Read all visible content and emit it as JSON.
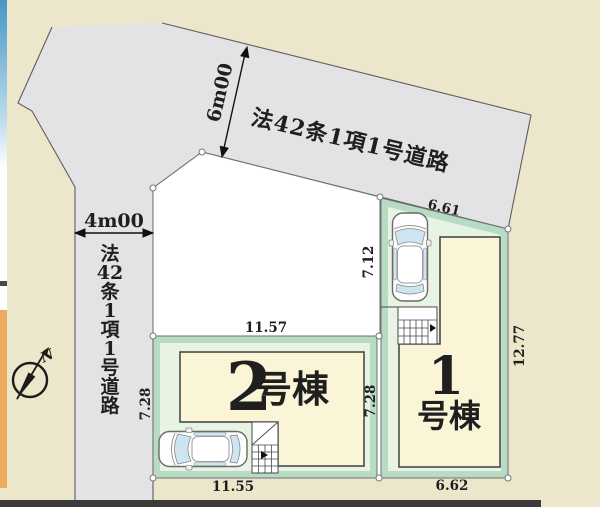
{
  "colors": {
    "background": "#ece7cb",
    "road_fill": "#e3e3e6",
    "road_stroke": "#5d5d60",
    "parcel_white": "#ffffff",
    "parcel_stroke": "#707070",
    "lot_green_outer": "#b7dcc3",
    "lot_green_inner": "#e7f3e3",
    "building_fill": "#fbf5d8",
    "building_stroke": "#3f3f3f",
    "glass_blue": "#cde4f1",
    "label_text": "#1f1f1f",
    "bottom_bar": "#3b3b3b",
    "edge_strip_blue": "#4597c7",
    "edge_strip_orange": "#ecaa5e",
    "marker_fill": "#ffffff",
    "compass_color": "#1c1c1c"
  },
  "roads": {
    "top_road_label": "法42条1項1号道路",
    "top_road_width": "6m00",
    "left_road_width": "4m00",
    "left_road_label_chars": [
      "法",
      "42",
      "条",
      "1",
      "項",
      "1",
      "号",
      "道",
      "路"
    ]
  },
  "lots": {
    "lot1": {
      "number": "1",
      "suffix": "号棟",
      "dim_top": "6.61",
      "dim_left": "7.12",
      "dim_right": "12.77",
      "dim_bottom": "6.62"
    },
    "lot2": {
      "number": "2",
      "suffix": "号棟",
      "dim_top": "11.57",
      "dim_left": "7.28",
      "dim_right": "7.28",
      "dim_bottom": "11.55"
    }
  },
  "compass": {
    "north_label": "N"
  }
}
